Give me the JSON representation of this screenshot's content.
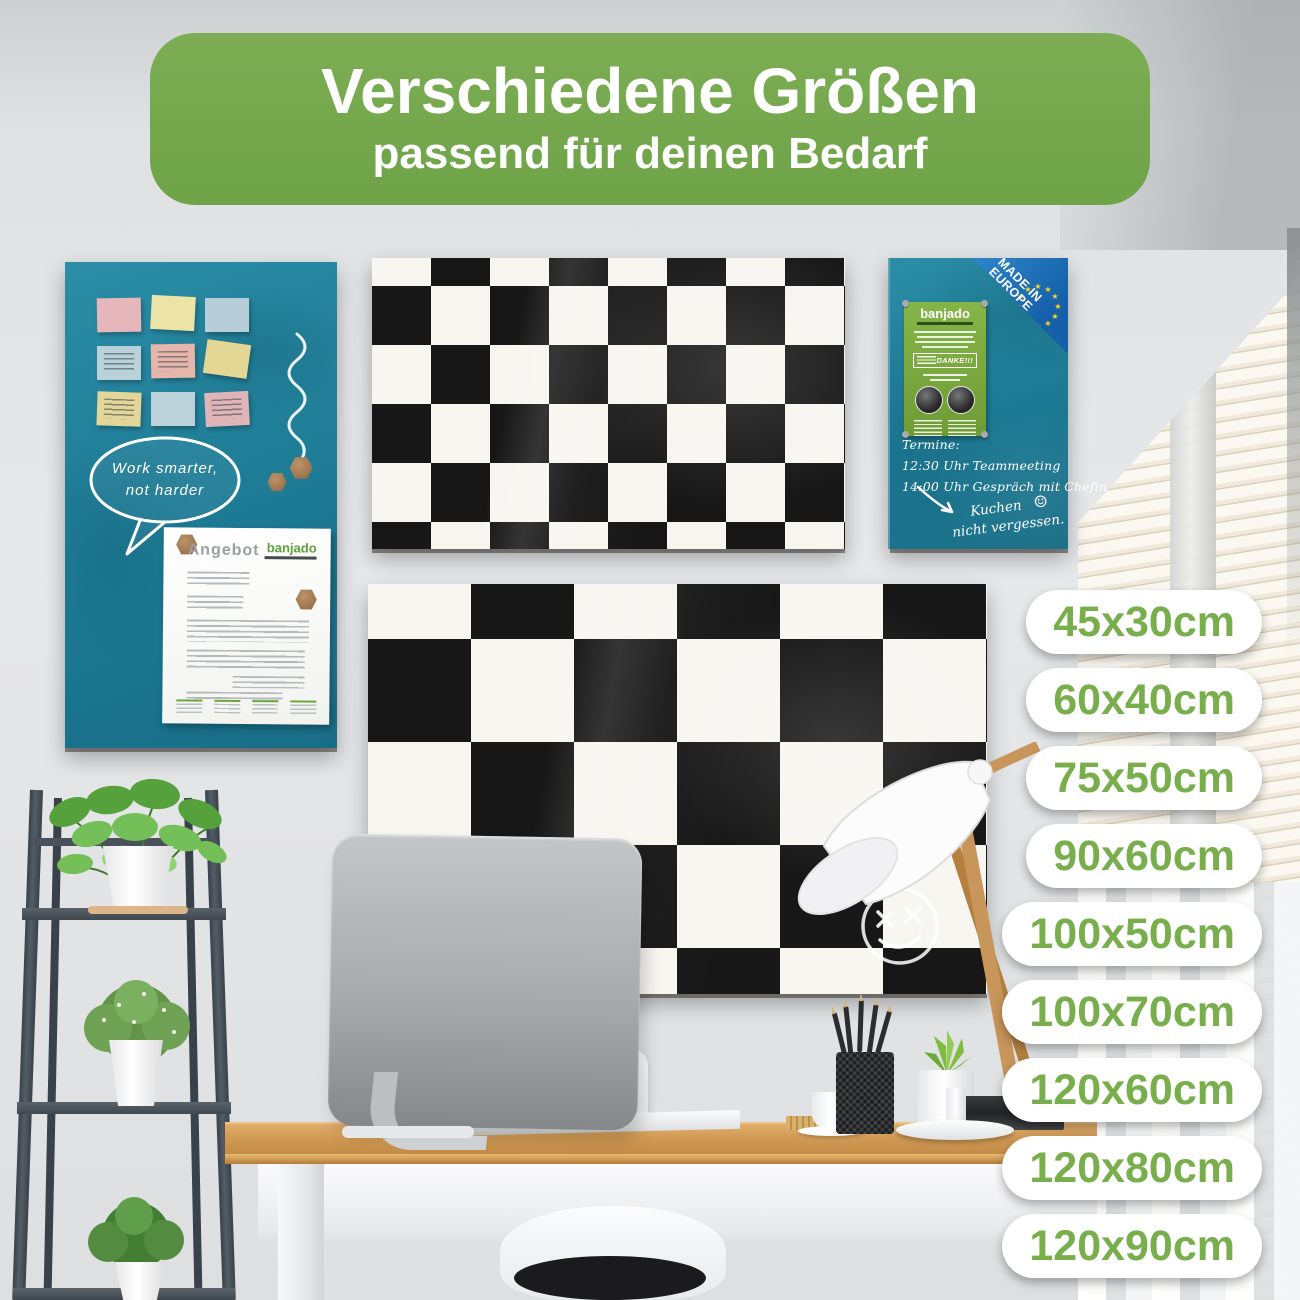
{
  "banner": {
    "title": "Verschiedene Größen",
    "subtitle": "passend für deinen Bedarf"
  },
  "sizes": [
    "45x30cm",
    "60x40cm",
    "75x50cm",
    "90x60cm",
    "100x50cm",
    "100x70cm",
    "120x60cm",
    "120x80cm",
    "120x90cm"
  ],
  "boards": {
    "left_glass_board": {
      "speech_bubble": [
        "Work smarter,",
        "not harder"
      ],
      "document": {
        "title": "Angebot",
        "brand": "banjado"
      }
    },
    "right_glass_board": {
      "made_in_badge": [
        "MADE IN",
        "EUROPE"
      ],
      "flyer": {
        "brand": "banjado",
        "highlight": "DANKE!!!"
      },
      "schedule": [
        "Termine:",
        "12:30 Uhr Teammeeting",
        "14:00 Uhr Gespräch mit Chefin"
      ],
      "reminder": [
        "Kuchen",
        "nicht vergessen."
      ],
      "reminder_smiley": "☺"
    }
  },
  "colors": {
    "banner_green": "#74a74d",
    "badge_text_green": "#79ae4d",
    "board_teal": "#1f7f99",
    "checker_black": "#171717",
    "checker_white": "#f8f6f1",
    "made_in_blue": "#1a6ab4",
    "eu_star_yellow": "#ffd617",
    "flyer_green": "#7fae3f"
  }
}
